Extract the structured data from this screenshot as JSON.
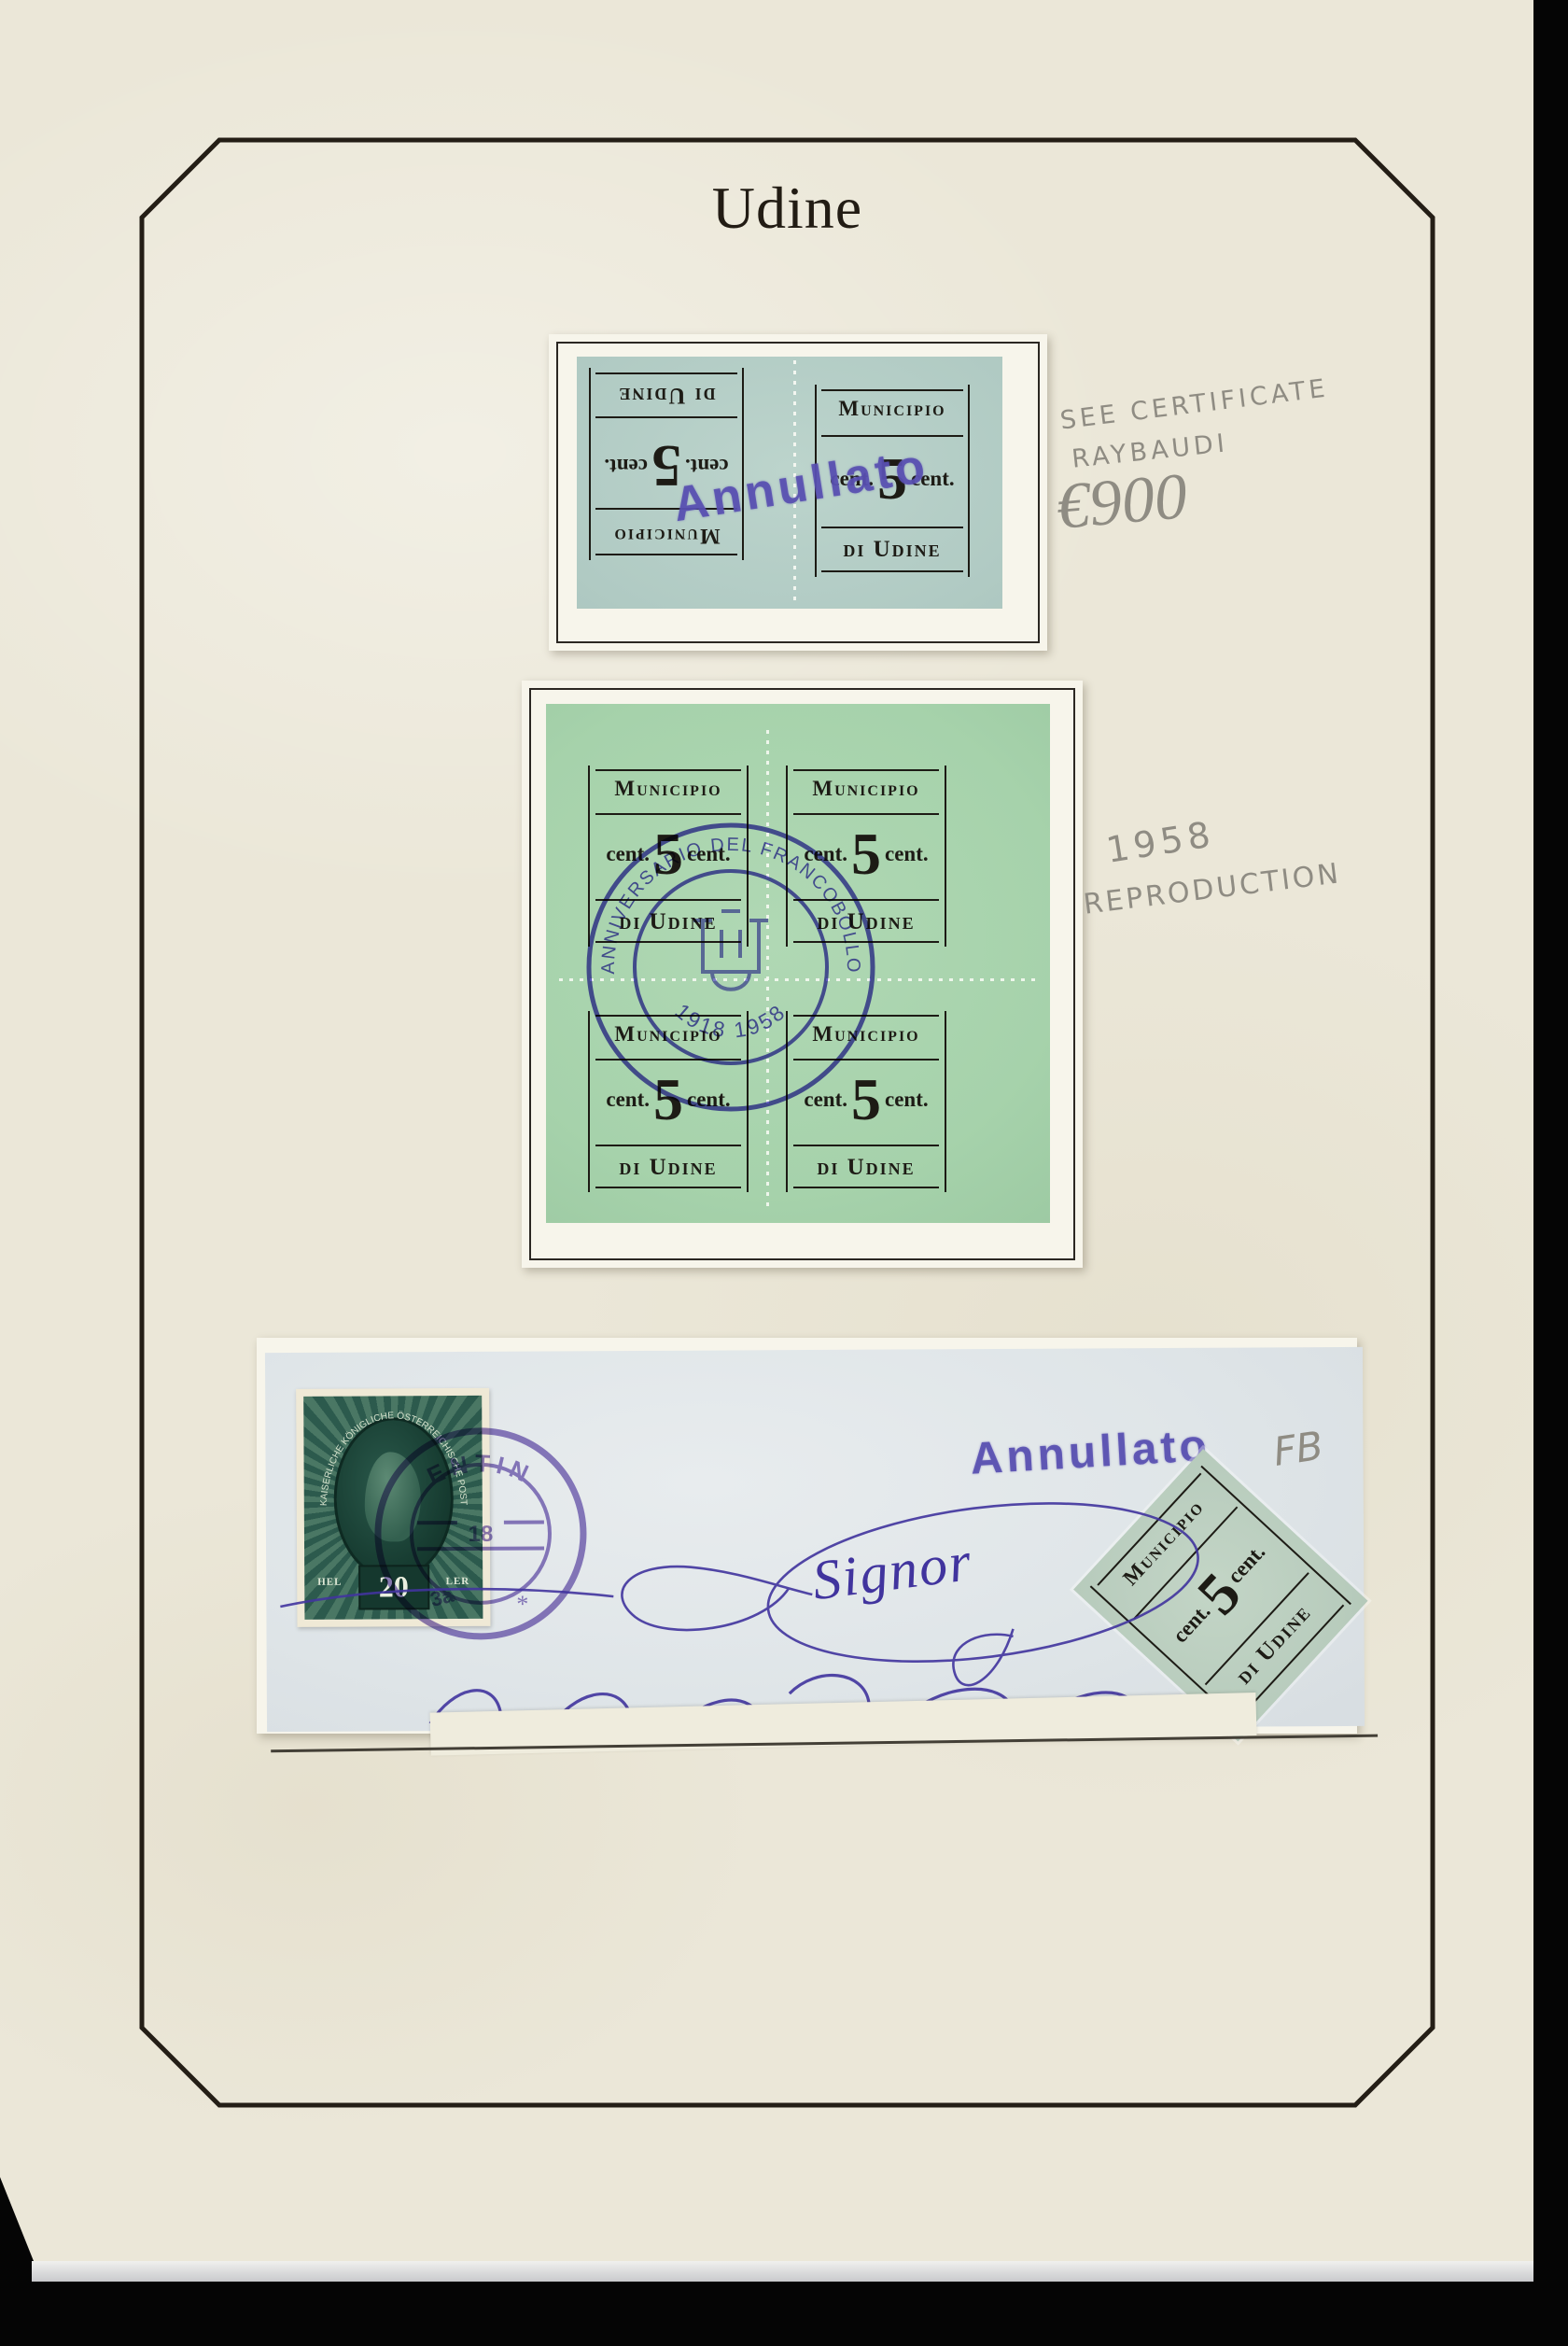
{
  "page": {
    "title": "Udine"
  },
  "municipio_stamp": {
    "header": "Municipio",
    "unit_left": "cent.",
    "value": "5",
    "unit_right": "cent.",
    "footer": "di Udine"
  },
  "item_pair": {
    "cancel_text": "Annullato",
    "annotation_line1": "SEE CERTIFICATE",
    "annotation_line2": "RAYBAUDI",
    "price": "€900"
  },
  "item_block": {
    "cancel_ring_text": "ANNIVERSARIO DEL FRANCOBOLLO",
    "cancel_years": "1918 1958",
    "annotation_line1": "1958",
    "annotation_line2": "REPRODUCTION"
  },
  "item_cover": {
    "cancel_text": "Annullato",
    "expert_initials": "FB",
    "address_line": "Signor",
    "austrian_stamp": {
      "arc_text": "KAISERLICHE KÖNIGLICHE ÖSTERREICHISCHE POST",
      "left_tablet": "HEL",
      "right_tablet": "LER",
      "denomination": "20"
    },
    "postmark": {
      "arc_text": "ENTIN",
      "date_text": "18",
      "index_text": "3a",
      "star": "*"
    }
  },
  "colors": {
    "handstamp_violet": "#584fb0",
    "block_cancel_blue": "#4b43c2",
    "cover_postmark_purple": "#7e68bc",
    "address_ink": "#41349e",
    "pencil_grey": "#8f8c83",
    "pair_paper_green": "#b0cac3",
    "block_paper_green": "#a6d2ab",
    "austrian_stamp_green": "#2e5f51"
  }
}
